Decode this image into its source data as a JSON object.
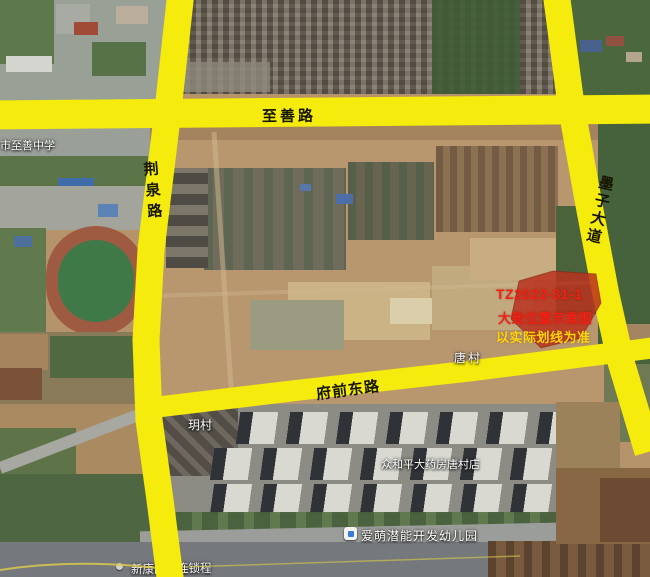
{
  "map": {
    "roads": {
      "zhishan": "至善路",
      "jingquan": "荆泉路",
      "mozi": "墨子大道",
      "fuqian": "府前东路"
    },
    "parcel": {
      "id": "TZ2022-31-1",
      "note1": "大致位置示意图",
      "note2": "以实际划线为准"
    },
    "pois": {
      "school": "市至善中学",
      "tang_village": "唐村",
      "yue_village": "玥村",
      "pharmacy": "众和平大药房唐村店",
      "kindergarten": "爱萌潜能开发幼儿园",
      "store_left": "新康医",
      "store_right": "连锁程"
    },
    "colors": {
      "road_overlay": "#f5eb0c",
      "parcel_fill": "#b8311f",
      "parcel_id_text": "#f32013",
      "note_text": "#ffd60a"
    }
  }
}
